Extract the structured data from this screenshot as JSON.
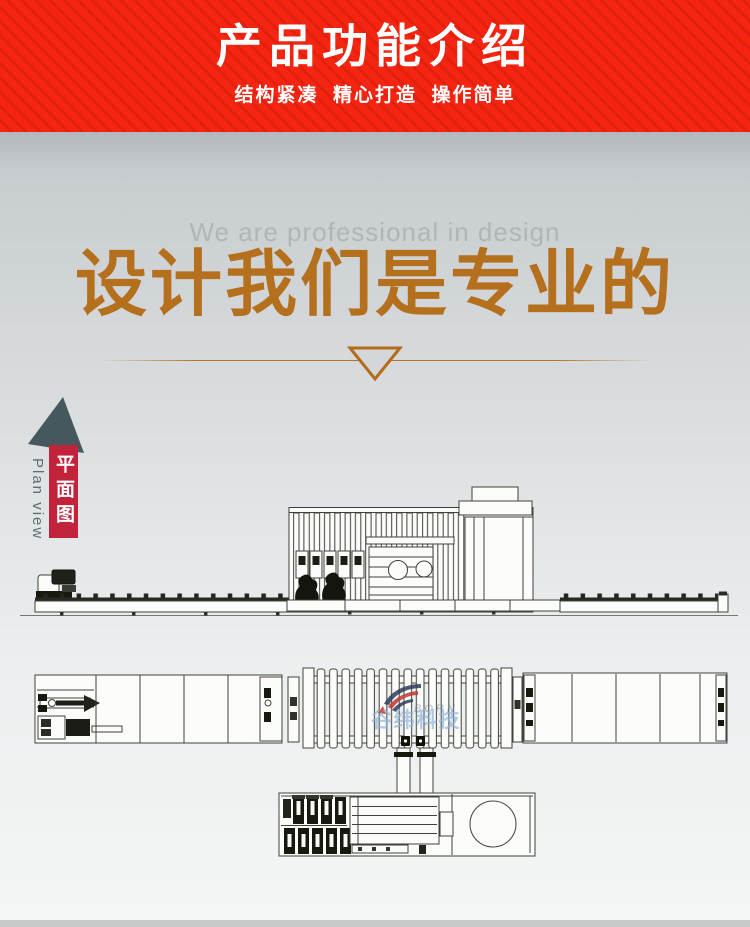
{
  "banner": {
    "title": "产品功能介绍",
    "subtitle": "结构紧凑  精心打造  操作简单",
    "bg_color": "#f52511",
    "text_color": "#ffffff"
  },
  "design_section": {
    "subtitle_en": "We are professional in design",
    "title_cn": "设计我们是专业的",
    "accent_color": "#b5701e"
  },
  "plan_marker": {
    "label_cn": "平面图",
    "label_en": "Plan view",
    "arrow_color": "#45585e",
    "label_bg_color": "#c1243a"
  },
  "watermark": {
    "brand_cn": "谷纬科技",
    "brand_en": "BORN"
  }
}
